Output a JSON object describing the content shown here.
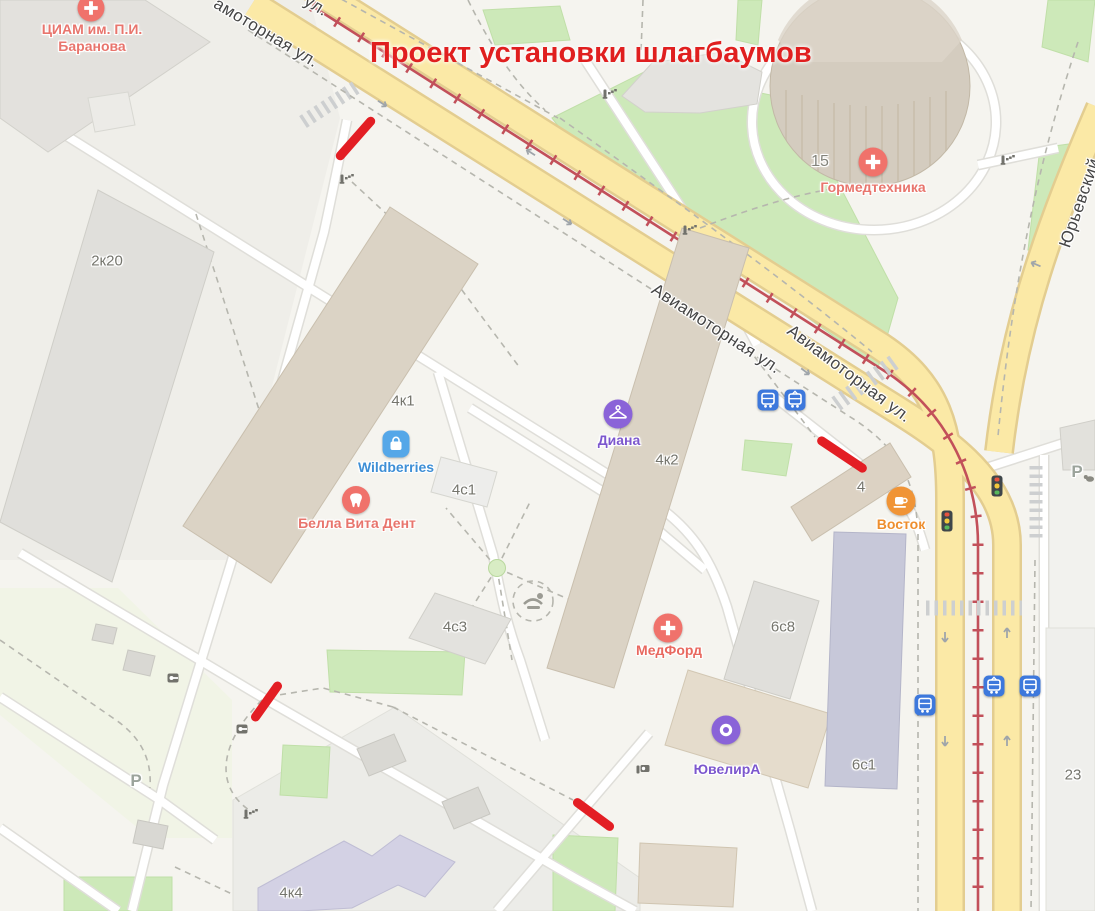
{
  "title": {
    "text": "Проект установки шлагбаумов"
  },
  "streets": {
    "aviamotornaya": "Авиамоторная ул.",
    "aviamotornaya_partial": "амоторная ул.",
    "ul_partial": "ул.",
    "yuryevsky": "Юрьевский"
  },
  "building_labels": {
    "b2k20": "2к20",
    "b4k1": "4к1",
    "b4s1": "4с1",
    "b4k2": "4к2",
    "b4s3": "4с3",
    "b6s8": "6с8",
    "b4": "4",
    "b6s1": "6с1",
    "b23": "23",
    "b15": "15",
    "b4k4": "4к4"
  },
  "pois": {
    "ciam": {
      "line1": "ЦИАМ им. П.И.",
      "line2": "Баранова"
    },
    "gormed": {
      "name": "Гормедтехника"
    },
    "wildberries": {
      "name": "Wildberries"
    },
    "bella": {
      "name": "Белла Вита Дент"
    },
    "diana": {
      "name": "Диана"
    },
    "medford": {
      "name": "МедФорд"
    },
    "vostok": {
      "name": "Восток"
    },
    "yuvelira": {
      "name": "ЮвелирА"
    }
  },
  "parking": {
    "label": "P"
  },
  "colors": {
    "title": "#E01F1F",
    "marker": "#E31E24",
    "road_fill": "#FBE9A6",
    "road_casing": "#E3CD90",
    "tram_line": "#C2505A",
    "poi_medical": "#F0726B",
    "poi_shopping_bg": "#55A7E8",
    "poi_shopping_text": "#3E8FD6",
    "poi_purple": "#8A63D8",
    "poi_purple_text": "#7C57CE",
    "poi_food": "#F09436",
    "poi_food_text": "#EE8E2E",
    "transit_blue": "#3D78DC",
    "green_area": "#CDE9B9",
    "building_beige": "#DBD3C5"
  }
}
